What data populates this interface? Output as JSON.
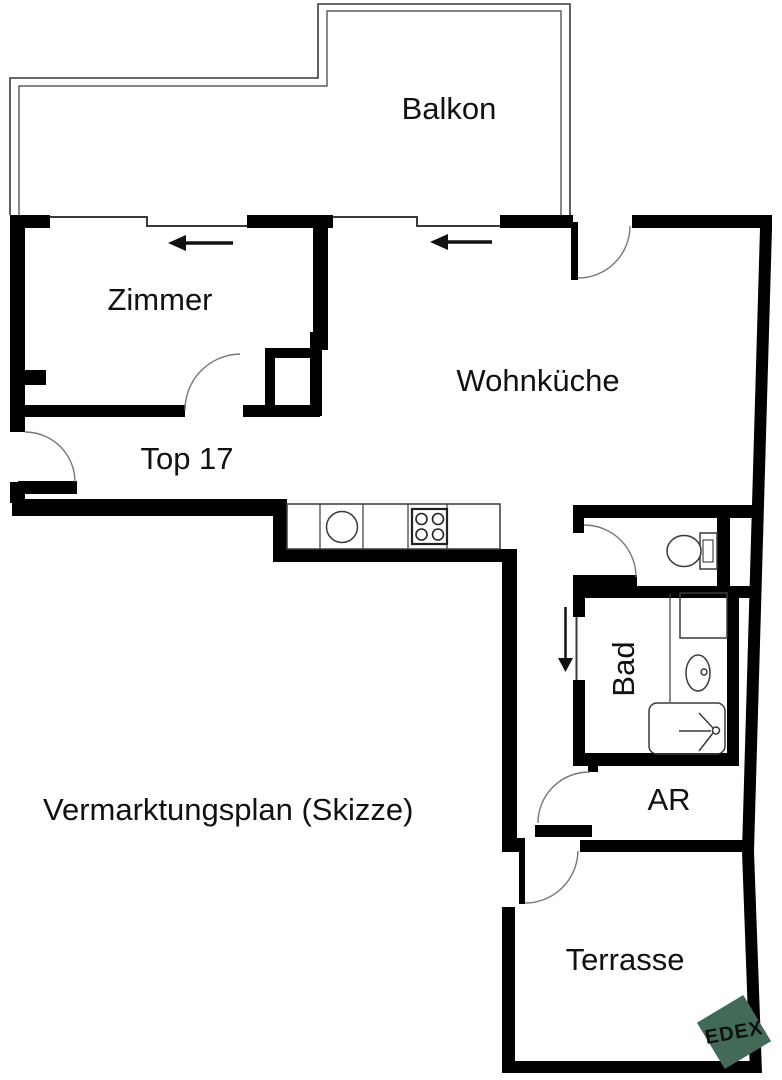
{
  "plan": {
    "title": "Vermarktungsplan (Skizze)",
    "unit": "Top 17"
  },
  "rooms": {
    "balkon": "Balkon",
    "zimmer": "Zimmer",
    "wohnkueche": "Wohnküche",
    "bad": "Bad",
    "ar": "AR",
    "terrasse": "Terrasse"
  },
  "logo": {
    "text": "EDEX",
    "color": "#426a57",
    "text_color": "#ffffff"
  },
  "colors": {
    "wall": "#000000",
    "thin_line": "#3a3a3a",
    "background": "#ffffff",
    "label": "#111111"
  },
  "icons": {
    "fixtures": [
      "sink-icon",
      "stove-icon",
      "toilet-icon",
      "washbasin-icon",
      "shower-icon"
    ],
    "symbols": [
      "door-swing-arc",
      "window-line",
      "direction-arrow-icon"
    ]
  }
}
